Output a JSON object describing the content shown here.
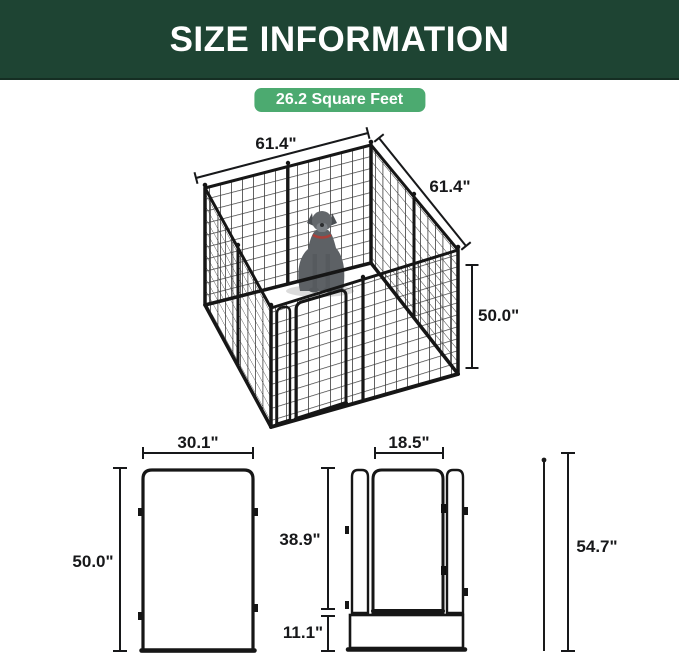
{
  "header": {
    "title": "SIZE INFORMATION",
    "bg_color": "#1e4433",
    "text_color": "#ffffff"
  },
  "badge": {
    "text": "26.2 Square Feet",
    "bg_color": "#4caa70",
    "text_color": "#ffffff"
  },
  "main_diagram": {
    "subject": "isometric 8-panel metal dog playpen with sitting dog inside",
    "width_label": "61.4\"",
    "depth_label": "61.4\"",
    "height_label": "50.0\""
  },
  "panel_diagram": {
    "subject": "single mesh panel front view",
    "width_label": "30.1\"",
    "height_label": "50.0\""
  },
  "door_panel_diagram": {
    "subject": "door panel front view",
    "door_width_label": "18.5\"",
    "door_height_label": "38.9\"",
    "bottom_height_label": "11.1\""
  },
  "stake_diagram": {
    "subject": "ground stake",
    "height_label": "54.7\""
  },
  "colors": {
    "line_color": "#17181a",
    "mesh_color": "#3d3d3d"
  }
}
